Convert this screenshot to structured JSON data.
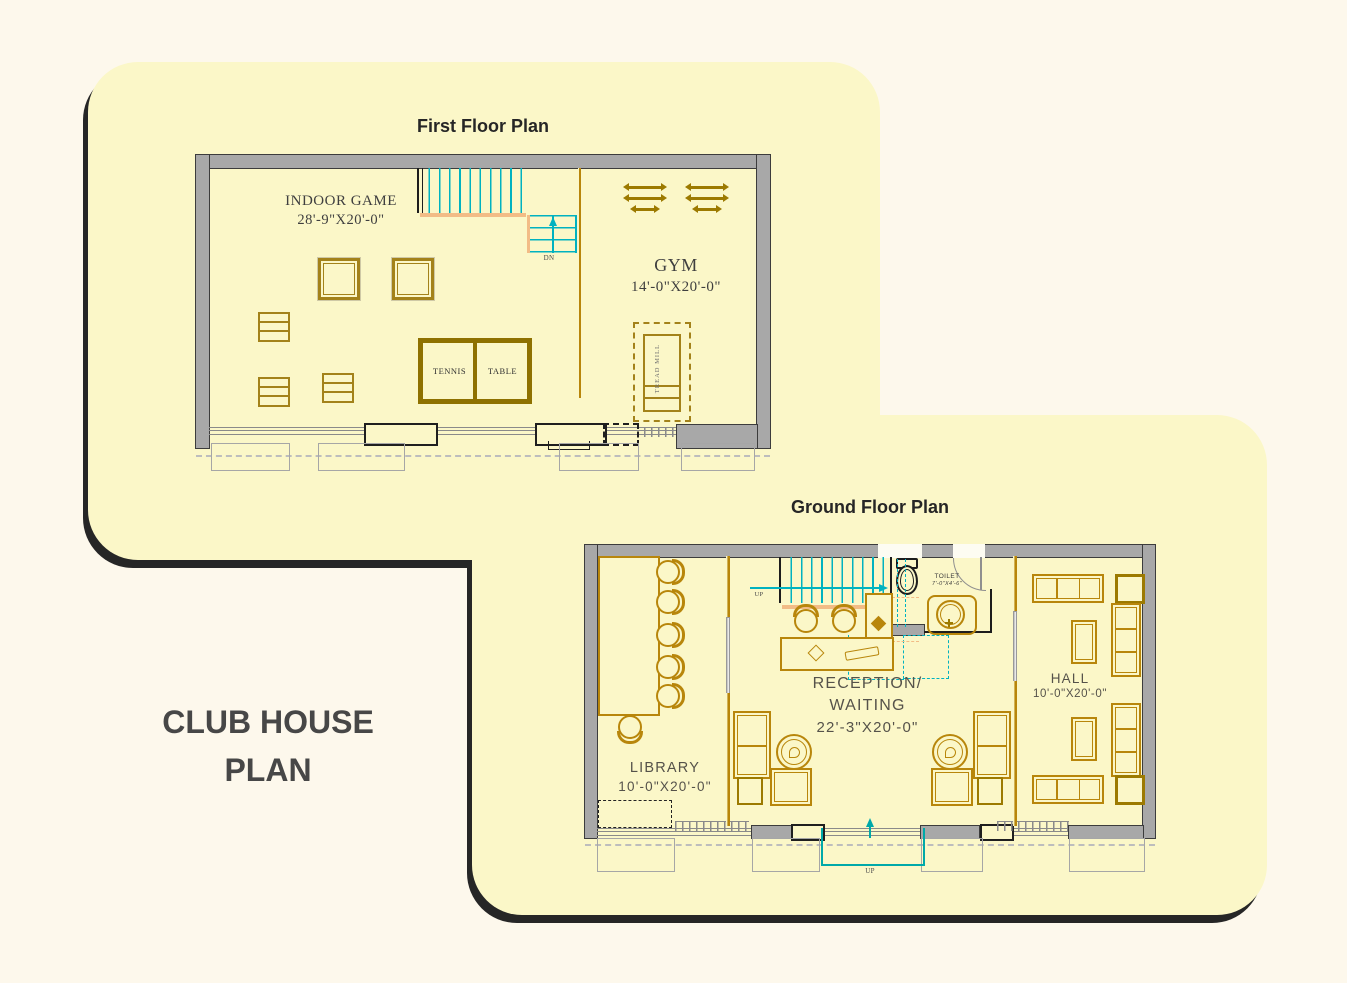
{
  "main_title": {
    "line1": "CLUB HOUSE",
    "line2": "PLAN"
  },
  "first_floor": {
    "title": "First Floor Plan",
    "indoor_game": {
      "name": "INDOOR GAME",
      "dim": "28'-9\"X20'-0\""
    },
    "gym": {
      "name": "GYM",
      "dim": "14'-0\"X20'-0\""
    },
    "tennis_table": {
      "word1": "TENNIS",
      "word2": "TABLE"
    },
    "treadmill_label": "TREAD MILL",
    "stairs_down_label": "DN"
  },
  "ground_floor": {
    "title": "Ground Floor Plan",
    "library": {
      "name": "LIBRARY",
      "dim": "10'-0\"X20'-0\""
    },
    "reception": {
      "name_line1": "RECEPTION/",
      "name_line2": "WAITING",
      "dim": "22'-3\"X20'-0\""
    },
    "hall": {
      "name": "HALL",
      "dim": "10'-0\"X20'-0\""
    },
    "toilet": {
      "name": "TOILET",
      "dim": "7'-0\"X4'-6\""
    },
    "stairs_up_label": "UP",
    "entry_up_label": "UP"
  },
  "colors": {
    "background": "#fdf8ec",
    "panel": "#fbf7c8",
    "panel_shadow": "#262626",
    "wall": "#a8a8a8",
    "furniture_gold": "#b8860b",
    "stair_cyan": "#00b2c0",
    "entry_teal": "#00a9a9",
    "landing_peach": "#f2bc86",
    "title_ink": "#262626"
  }
}
